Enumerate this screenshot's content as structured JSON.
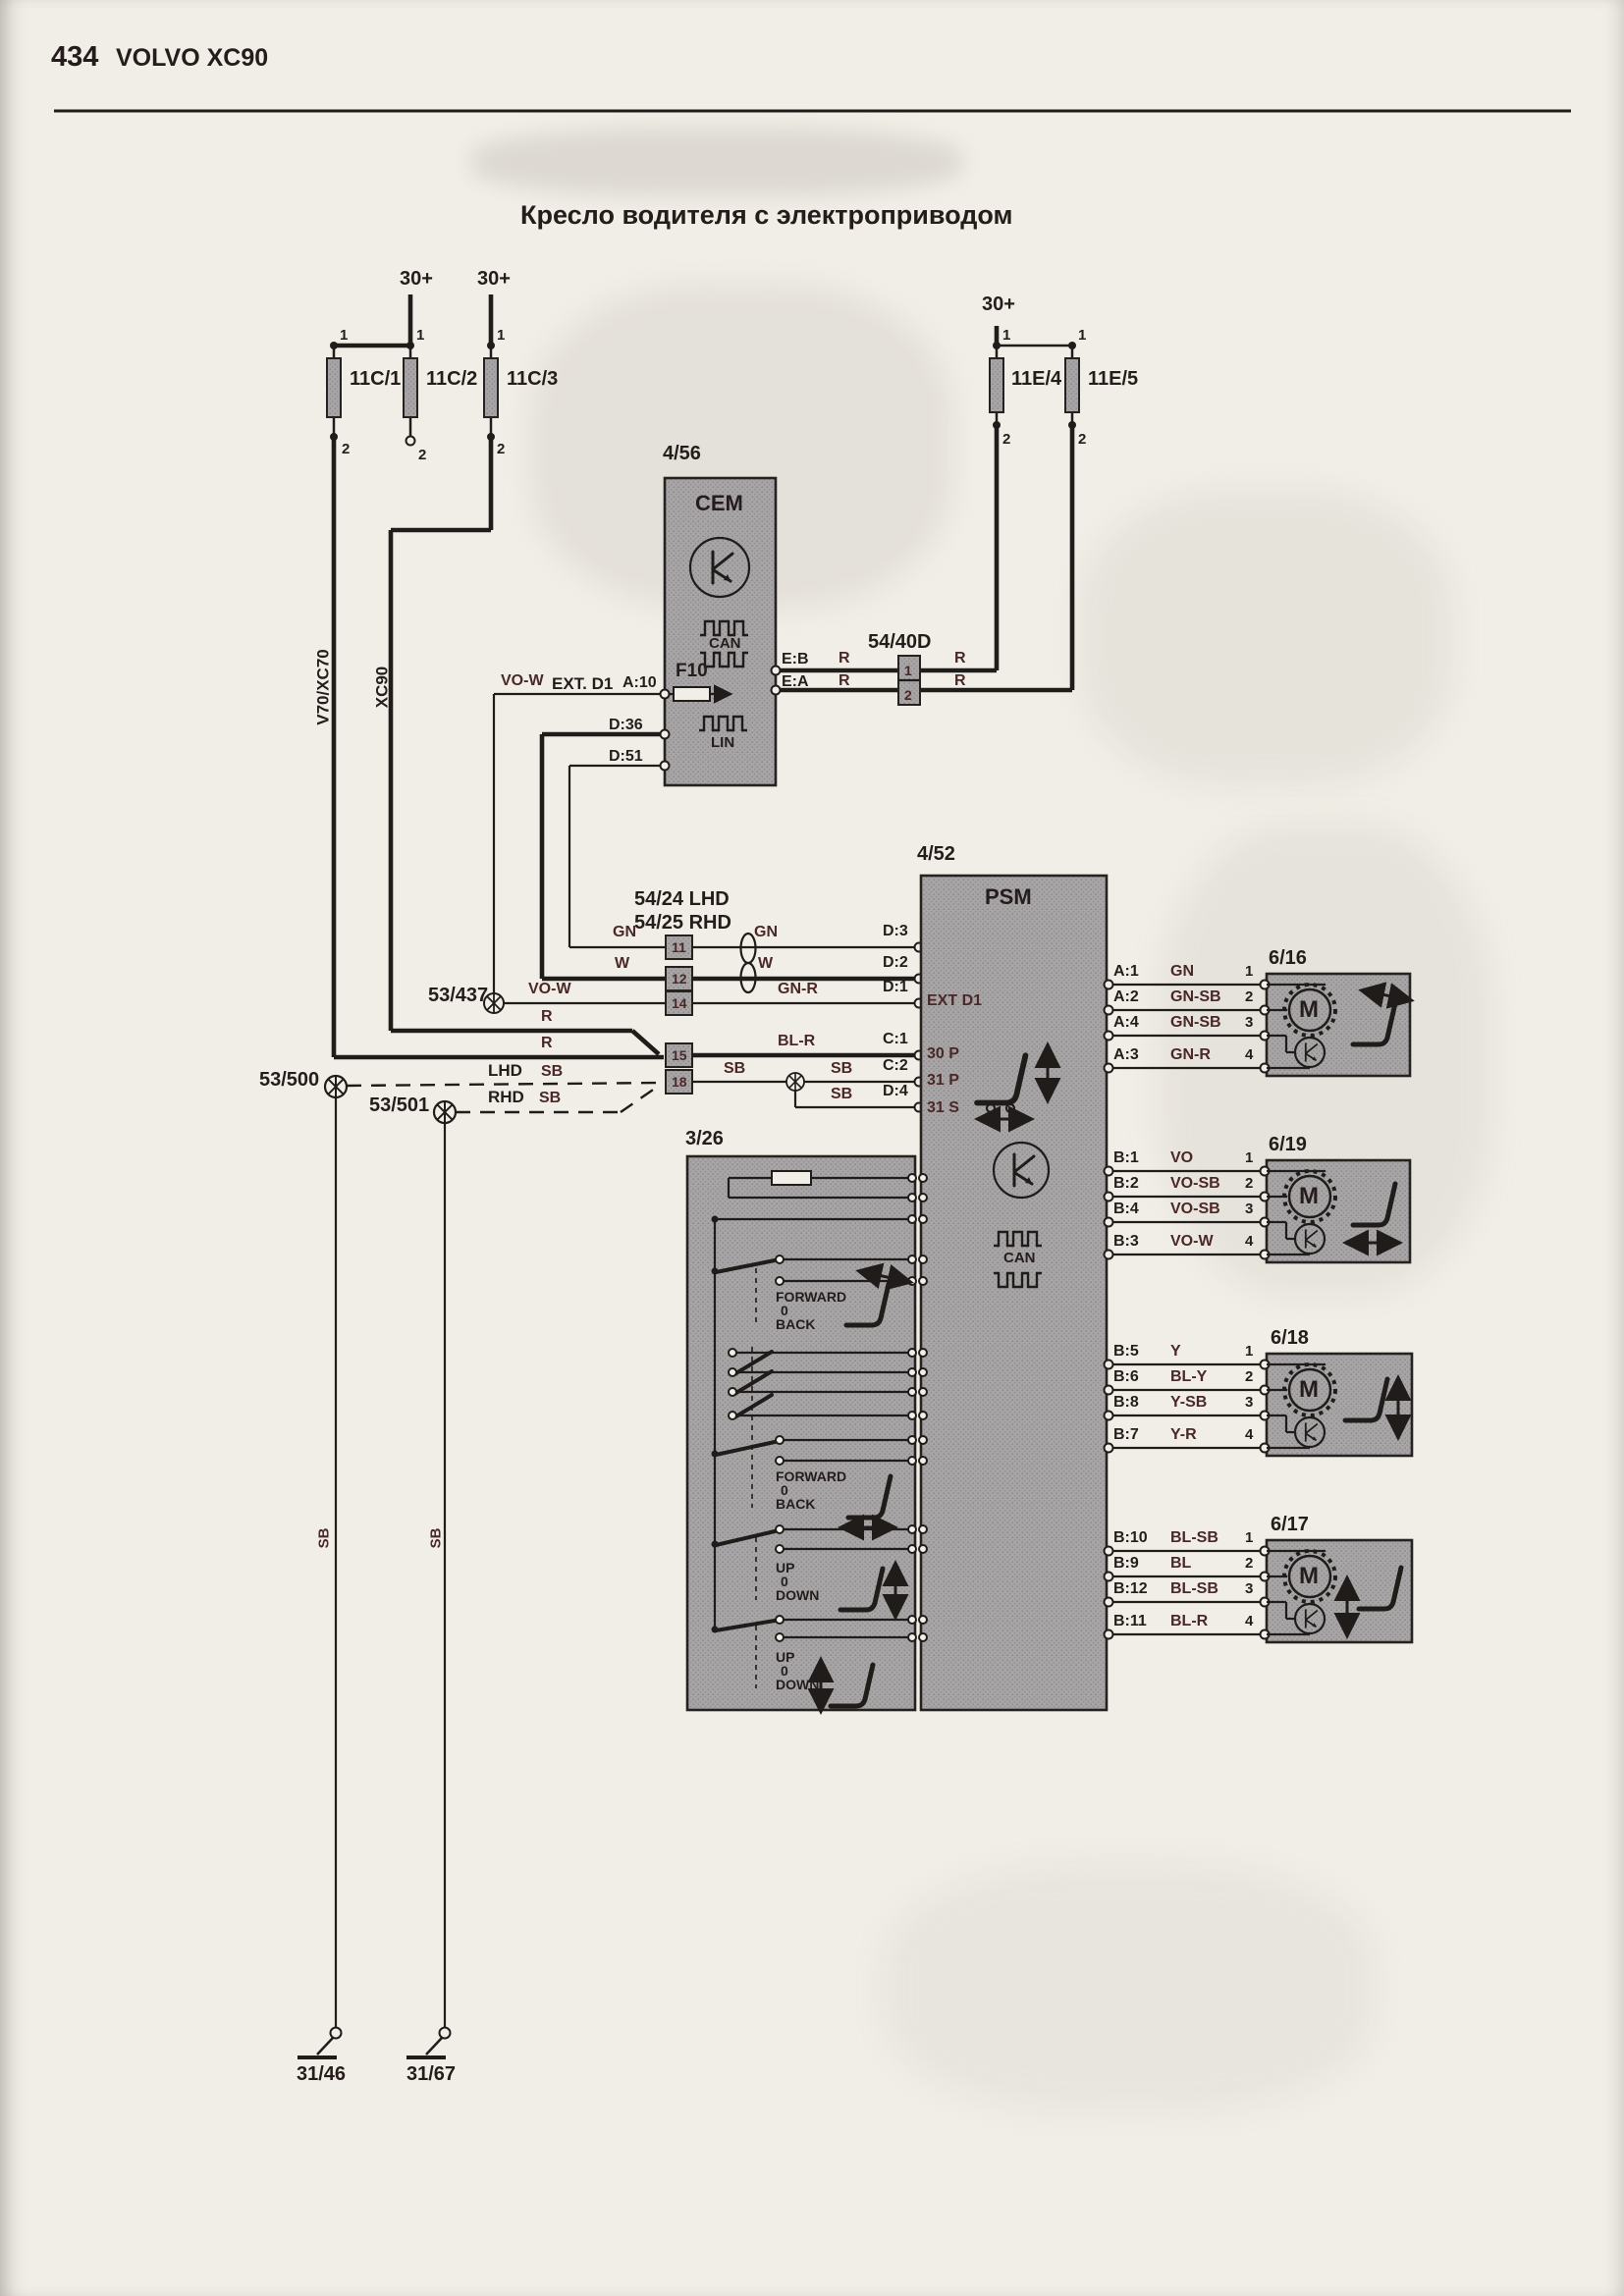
{
  "colors": {
    "paper": "#f1eee7",
    "module_gray": "#a8a5a7",
    "line": "#1f1c1a",
    "label_maroon": "#4a2828"
  },
  "page": {
    "number": "434",
    "brand": "VOLVO XC90"
  },
  "title": "Кресло водителя с электроприводом",
  "labels": {
    "supply": "30+",
    "pin1": "1",
    "pin2": "2",
    "v70": "V70/XC70",
    "xc90": "XC90",
    "lhd": "LHD",
    "rhd": "RHD",
    "sb": "SB",
    "r": "R",
    "gn": "GN",
    "w": "W",
    "gn_r": "GN-R",
    "bl_r": "BL-R",
    "vo_w": "VO-W"
  },
  "fuses": {
    "c1": "11C/1",
    "c2": "11C/2",
    "c3": "11C/3",
    "e4": "11E/4",
    "e5": "11E/5"
  },
  "cem": {
    "id": "4/56",
    "name": "CEM",
    "can": "CAN",
    "lin": "LIN",
    "f10": "F10",
    "ext_d1": "EXT. D1",
    "a10": "A:10",
    "d36": "D:36",
    "d51": "D:51",
    "eb": "E:B",
    "ea": "E:A"
  },
  "c5440d": {
    "id": "54/40D",
    "p1": "1",
    "p2": "2"
  },
  "c5424": {
    "lhd": "54/24 LHD",
    "rhd": "54/25 RHD",
    "p11": "11",
    "p12": "12",
    "p14": "14",
    "p15": "15",
    "p18": "18"
  },
  "splices": {
    "s437": "53/437",
    "s500": "53/500",
    "s501": "53/501"
  },
  "psm": {
    "id": "4/52",
    "name": "PSM",
    "can": "CAN",
    "d3": "D:3",
    "d2": "D:2",
    "d1": "D:1",
    "c1": "C:1",
    "c2": "C:2",
    "d4": "D:4",
    "ext": "EXT D1",
    "p30": "30 P",
    "p31": "31 P",
    "s31": "31 S"
  },
  "motors": [
    {
      "id": "6/16",
      "m": "M",
      "rows": [
        {
          "psm": "A:1",
          "wire": "GN",
          "pin": "1"
        },
        {
          "psm": "A:2",
          "wire": "GN-SB",
          "pin": "2"
        },
        {
          "psm": "A:4",
          "wire": "GN-SB",
          "pin": "3"
        },
        {
          "psm": "A:3",
          "wire": "GN-R",
          "pin": "4"
        }
      ]
    },
    {
      "id": "6/19",
      "m": "M",
      "rows": [
        {
          "psm": "B:1",
          "wire": "VO",
          "pin": "1"
        },
        {
          "psm": "B:2",
          "wire": "VO-SB",
          "pin": "2"
        },
        {
          "psm": "B:4",
          "wire": "VO-SB",
          "pin": "3"
        },
        {
          "psm": "B:3",
          "wire": "VO-W",
          "pin": "4"
        }
      ]
    },
    {
      "id": "6/18",
      "m": "M",
      "rows": [
        {
          "psm": "B:5",
          "wire": "Y",
          "pin": "1"
        },
        {
          "psm": "B:6",
          "wire": "BL-Y",
          "pin": "2"
        },
        {
          "psm": "B:8",
          "wire": "Y-SB",
          "pin": "3"
        },
        {
          "psm": "B:7",
          "wire": "Y-R",
          "pin": "4"
        }
      ]
    },
    {
      "id": "6/17",
      "m": "M",
      "rows": [
        {
          "psm": "B:10",
          "wire": "BL-SB",
          "pin": "1"
        },
        {
          "psm": "B:9",
          "wire": "BL",
          "pin": "2"
        },
        {
          "psm": "B:12",
          "wire": "BL-SB",
          "pin": "3"
        },
        {
          "psm": "B:11",
          "wire": "BL-R",
          "pin": "4"
        }
      ]
    }
  ],
  "sw": {
    "id": "3/26",
    "groups": [
      {
        "a": "FORWARD",
        "b": "0",
        "c": "BACK"
      },
      {
        "a": "FORWARD",
        "b": "0",
        "c": "BACK"
      },
      {
        "a": "UP",
        "b": "0",
        "c": "DOWN"
      },
      {
        "a": "UP",
        "b": "0",
        "c": "DOWN"
      }
    ]
  },
  "grounds": {
    "g1": "31/46",
    "g2": "31/67"
  }
}
